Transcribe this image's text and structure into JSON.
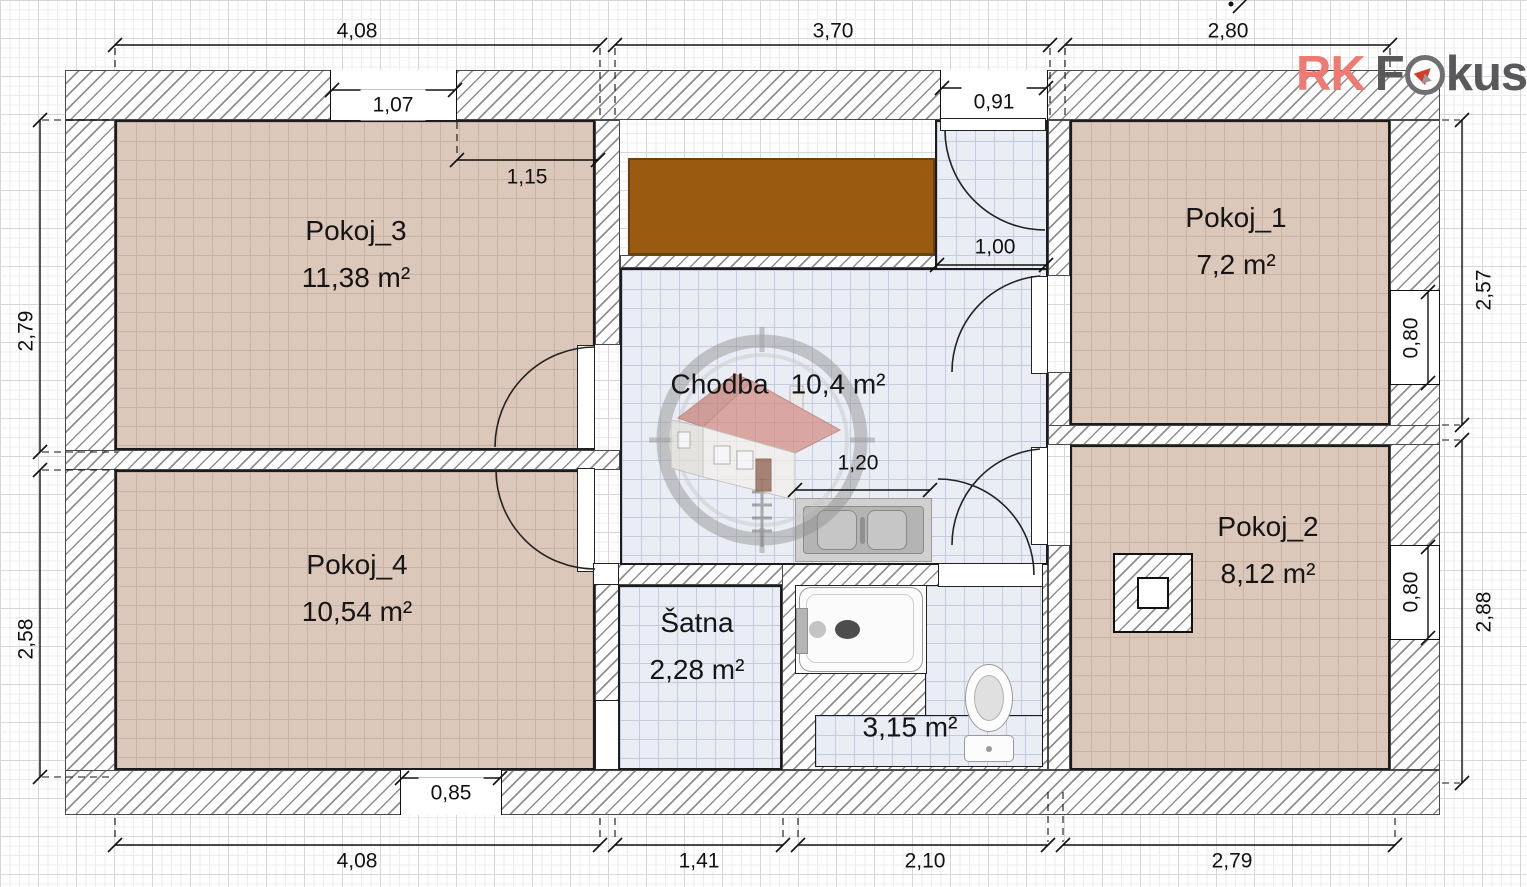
{
  "logo": {
    "part1": "RK",
    "part2": "F",
    "part3": "kus",
    "accent_color": "#ee7a72",
    "gray_color": "#59595b"
  },
  "rooms": {
    "pokoj1": {
      "name": "Pokoj_1",
      "area": "7,2 m²"
    },
    "pokoj2": {
      "name": "Pokoj_2",
      "area": "8,12 m²"
    },
    "pokoj3": {
      "name": "Pokoj_3",
      "area": "11,38 m²"
    },
    "pokoj4": {
      "name": "Pokoj_4",
      "area": "10,54 m²"
    },
    "chodba": {
      "name": "Chodba",
      "area": "10,4 m²"
    },
    "satna": {
      "name": "Šatna",
      "area": "2,28 m²"
    },
    "bathroom": {
      "area": "3,15 m²"
    }
  },
  "dims": {
    "top1": "4,08",
    "top2": "3,70",
    "top3": "2,80",
    "bottom1": "4,08",
    "bottom2": "1,41",
    "bottom3": "2,10",
    "bottom4": "2,79",
    "left1": "2,79",
    "left2": "2,58",
    "right1": "2,57",
    "right2": "2,88",
    "window_top": "1,07",
    "inner_p3": "1,15",
    "entry": "0,91",
    "nook": "1,00",
    "vanity": "1,20",
    "door_p4": "0,85",
    "window_r1": "0,80",
    "window_r2": "0,80"
  },
  "colors": {
    "wall_hatch": "#8f8f8f",
    "floor_room": "#dcc8ba",
    "floor_tile": "#eaedf4",
    "wardrobe": "#9a5a10",
    "line": "#111111"
  }
}
